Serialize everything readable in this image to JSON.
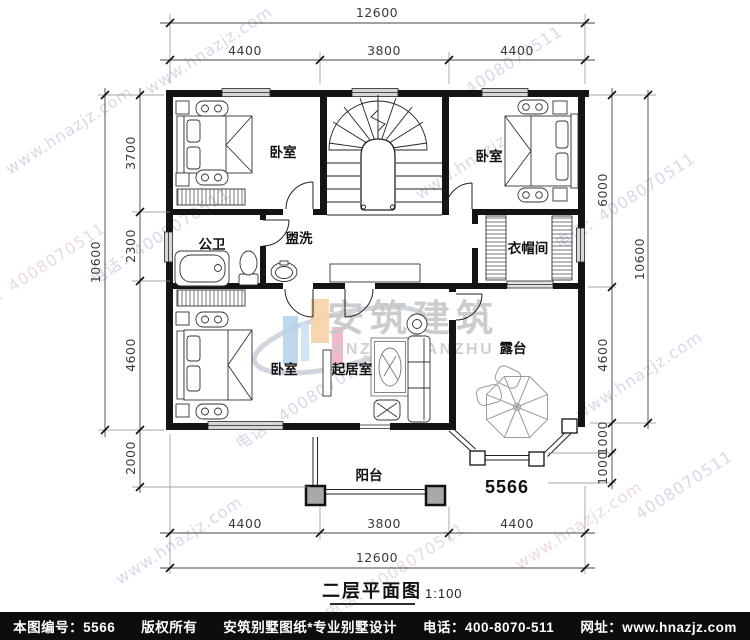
{
  "watermarks": {
    "site": "www.hnazjz.com",
    "phone": "电话：4008070511",
    "digits": "4008070511",
    "logo_cn": "安筑建筑",
    "logo_en": "ANZHU JIANZHU"
  },
  "plan": {
    "number": "5566",
    "rooms": {
      "bedroom_tl": "卧室",
      "bedroom_tr": "卧室",
      "bedroom_bl": "卧室",
      "bath": "公卫",
      "wash": "盥洗",
      "cloakroom": "衣帽间",
      "living": "起居室",
      "terrace": "露台",
      "balcony": "阳台"
    }
  },
  "dims": {
    "top_total": "12600",
    "top": [
      "4400",
      "3800",
      "4400"
    ],
    "bottom": [
      "4400",
      "3800",
      "4400"
    ],
    "bottom_total": "12600",
    "left_total": "10600",
    "left": [
      "3700",
      "2300",
      "4600",
      "2000"
    ],
    "right": [
      "6000",
      "4600",
      "1000",
      "1000"
    ],
    "right_total": "10600"
  },
  "title": {
    "text": "二层平面图",
    "scale": "1:100"
  },
  "footer": {
    "items": [
      "本图编号：5566",
      "版权所有",
      "安筑别墅图纸*专业别墅设计",
      "电话：400-8070-511",
      "网址：www.hnazjz.com"
    ]
  }
}
